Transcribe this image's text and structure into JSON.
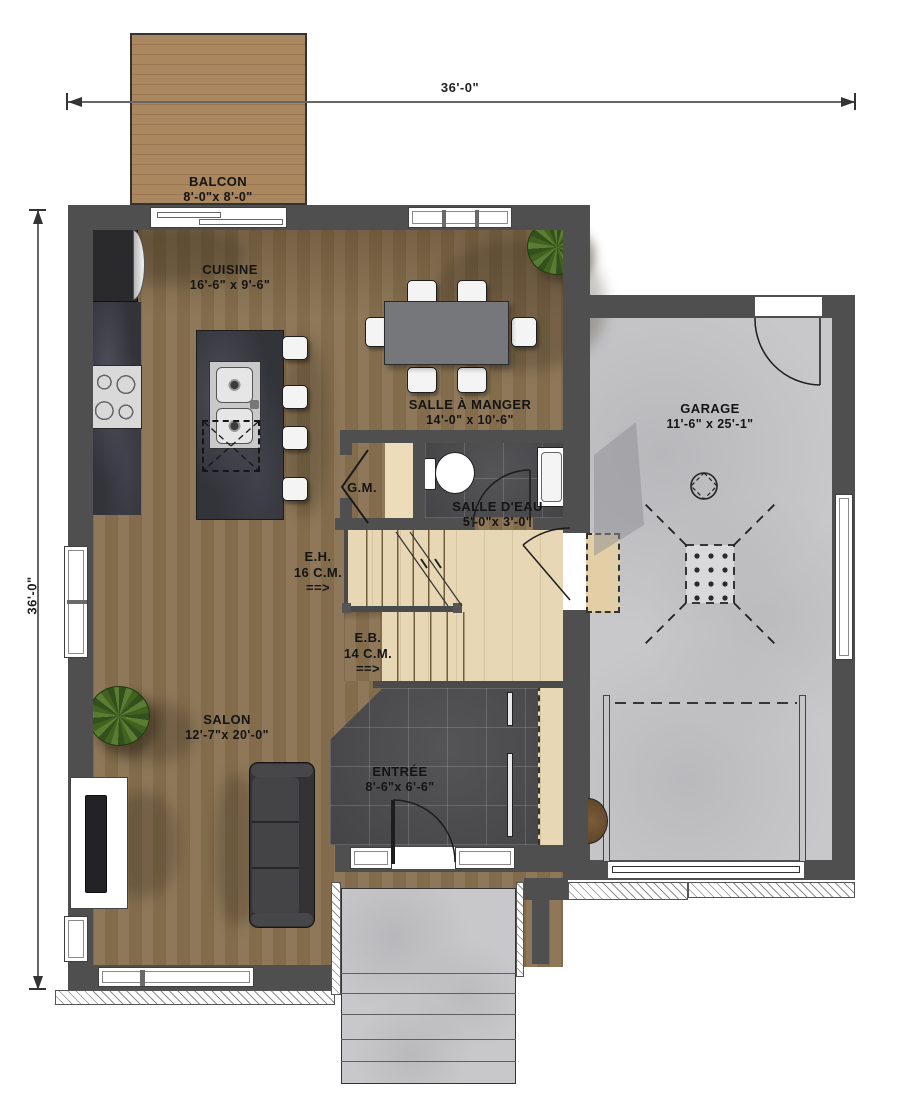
{
  "dimensions": {
    "top": "36'-0\"",
    "left": "36'-0\""
  },
  "rooms": {
    "balcon": {
      "name": "BALCON",
      "size": "8'-0\"x 8'-0\""
    },
    "cuisine": {
      "name": "CUISINE",
      "size": "16'-6\" x 9'-6\""
    },
    "salle_a_manger": {
      "name": "SALLE À MANGER",
      "size": "14'-0\" x 10'-6\""
    },
    "garage": {
      "name": "GARAGE",
      "size": "11'-6\" x 25'-1\""
    },
    "garde_manger": {
      "name": "G.M."
    },
    "salle_deau": {
      "name": "SALLE D'EAU",
      "size": "5'-0\"x 3'-0\""
    },
    "salon": {
      "name": "SALON",
      "size": "12'-7\"x 20'-0\""
    },
    "entree": {
      "name": "ENTRÉE",
      "size": "8'-6\"x 6'-6\""
    }
  },
  "stairs": {
    "up": {
      "abbr": "E.H.",
      "risers": "16 C.M.",
      "arrow": "==>"
    },
    "down": {
      "abbr": "E.B.",
      "risers": "14 C.M.",
      "arrow": "==>"
    }
  },
  "colors": {
    "wall": "#4f4f4f",
    "wood_floor": "#87704f",
    "balcony_wood": "#a8855e",
    "concrete": "#c8c8ca",
    "dark_tile": "#4a4a4d",
    "counter": "#33333a",
    "stair_wood": "#e7d7b5",
    "plant_green": "#5b7c33"
  }
}
